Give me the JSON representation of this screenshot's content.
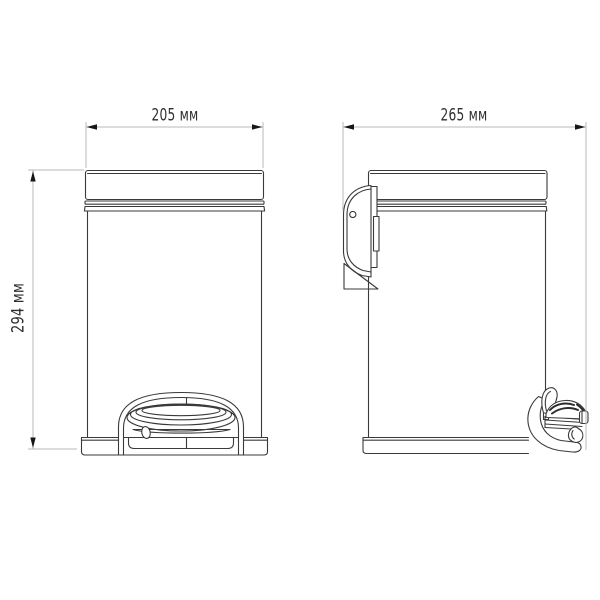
{
  "drawing": {
    "title": "pedal-bin-two-view-technical-drawing",
    "dimensions": {
      "front_width": "205 мм",
      "depth": "265 мм",
      "height": "294 мм"
    },
    "colors": {
      "background": "#ffffff",
      "line": "#3a3a3a",
      "dimension_line": "#b9b9b9",
      "arrow": "#161616",
      "text": "#2e2e2e"
    }
  }
}
